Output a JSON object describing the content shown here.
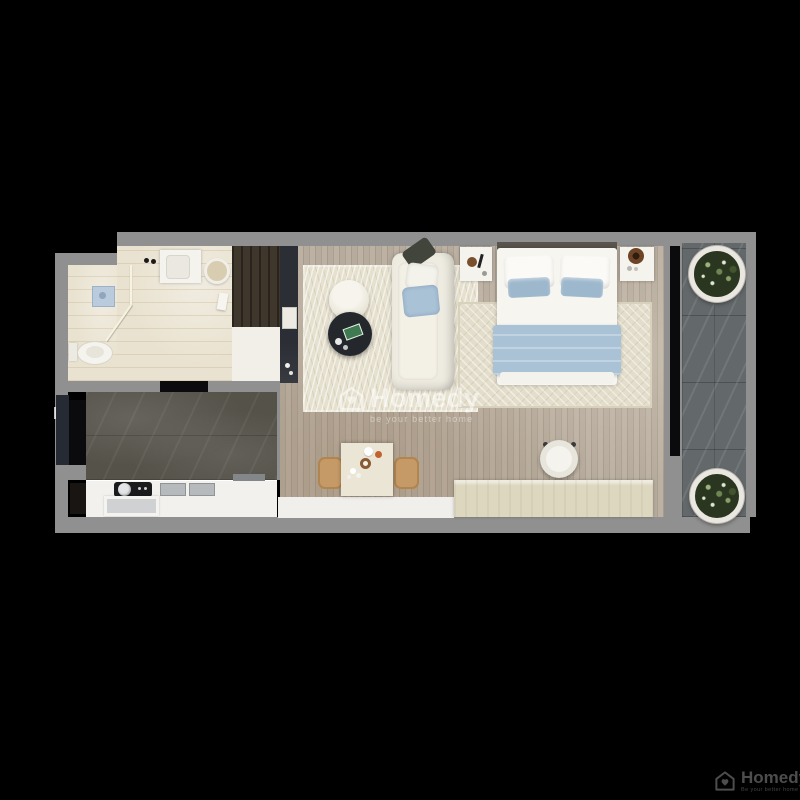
{
  "watermark": {
    "brand": "Homedy",
    "tagline": "be your better home"
  },
  "logo": {
    "brand": "Homedy",
    "tagline": "Be your better home"
  },
  "palette": {
    "bg": "#000000",
    "wall": "#909090",
    "floorWood": "#b6ab9d",
    "floorMarble": "#55524a",
    "floorBalcony": "#63686b",
    "rug": "#e6e0cf",
    "sofaCream": "#eeebe0",
    "darkTable": "#24282d",
    "accentBlue": "#a9c2d6",
    "benchBeige": "#ded7bf",
    "counterWhite": "#f2f1ed",
    "chairTan": "#c59a67",
    "watermark": "rgba(255,255,255,0.5)",
    "logoGray": "#4d4d4d"
  },
  "plan": {
    "type": "apartment-floor-plan-3d-render",
    "rooms": [
      {
        "name": "bathroom",
        "furniture": [
          "shower with glass partition and floor drain",
          "toilet",
          "vanity sink",
          "towel basket"
        ]
      },
      {
        "name": "kitchen-entry",
        "furniture": [
          "entry door",
          "dark marble floor",
          "counter with cooktop",
          "double sink",
          "lower cabinet"
        ]
      },
      {
        "name": "living-bedroom",
        "furniture": [
          "wardrobe",
          "tv cabinet",
          "sofa with blue pillows",
          "round dark coffee table",
          "cream ottoman",
          "double bed with blue blanket",
          "two nightstands with lamps",
          "desk chair",
          "dining table with two wooden chairs",
          "low beige cabinet",
          "two area rugs"
        ]
      },
      {
        "name": "balcony",
        "furniture": [
          "potted plant top",
          "potted plant bottom"
        ]
      }
    ]
  }
}
